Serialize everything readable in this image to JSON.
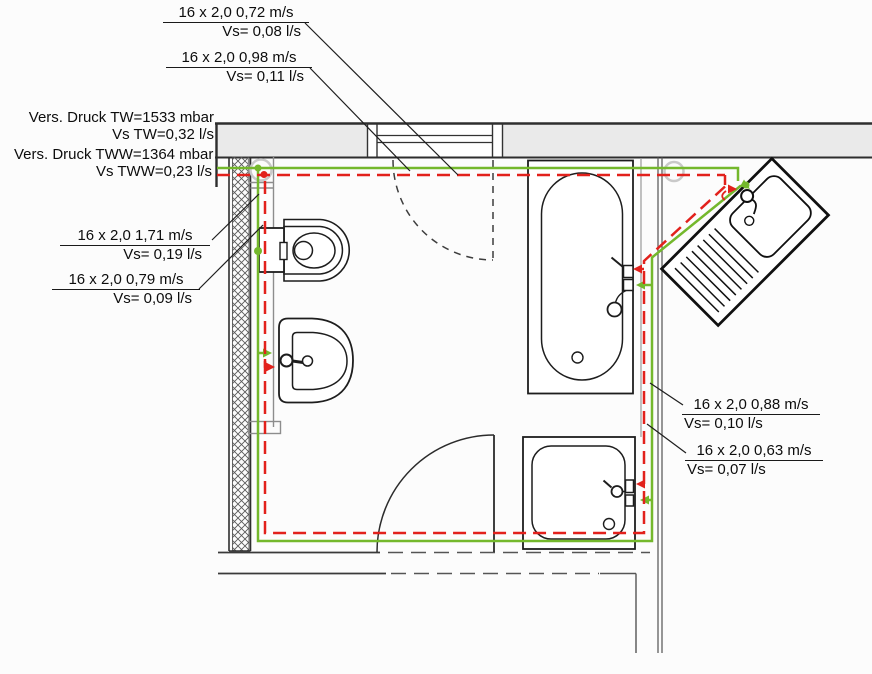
{
  "diagram": {
    "type": "bathroom-plumbing-floor-plan",
    "colors": {
      "cold_water_pipe_tw": "#74b82c",
      "hot_water_pipe_tww": "#e2211c",
      "wall_line": "#2e2e2e",
      "wall_fill": "#eaeaea",
      "leader_line": "#1e1e1e"
    },
    "fixtures": [
      "toilet",
      "washbasin",
      "bathtub",
      "shower-tray",
      "kitchen-sink",
      "door",
      "window"
    ]
  },
  "labels": {
    "flow_top_1": {
      "spec": "16 x 2,0 0,72 m/s",
      "flow": "Vs= 0,08 l/s"
    },
    "flow_top_2": {
      "spec": "16 x 2,0 0,98 m/s",
      "flow": "Vs= 0,11 l/s"
    },
    "supply_tw": {
      "spec": "Vers. Druck TW=1533 mbar",
      "flow": "Vs TW=0,32 l/s"
    },
    "supply_tww": {
      "spec": "Vers. Druck TWW=1364 mbar",
      "flow": "Vs TWW=0,23 l/s"
    },
    "flow_left_1": {
      "spec": "16 x 2,0 1,71 m/s",
      "flow": "Vs= 0,19 l/s"
    },
    "flow_left_2": {
      "spec": "16 x 2,0 0,79 m/s",
      "flow": "Vs= 0,09 l/s"
    },
    "flow_right_1": {
      "spec": "16 x 2,0 0,88 m/s",
      "flow": "Vs= 0,10 l/s"
    },
    "flow_right_2": {
      "spec": "16 x 2,0 0,63 m/s",
      "flow": "Vs= 0,07 l/s"
    }
  }
}
